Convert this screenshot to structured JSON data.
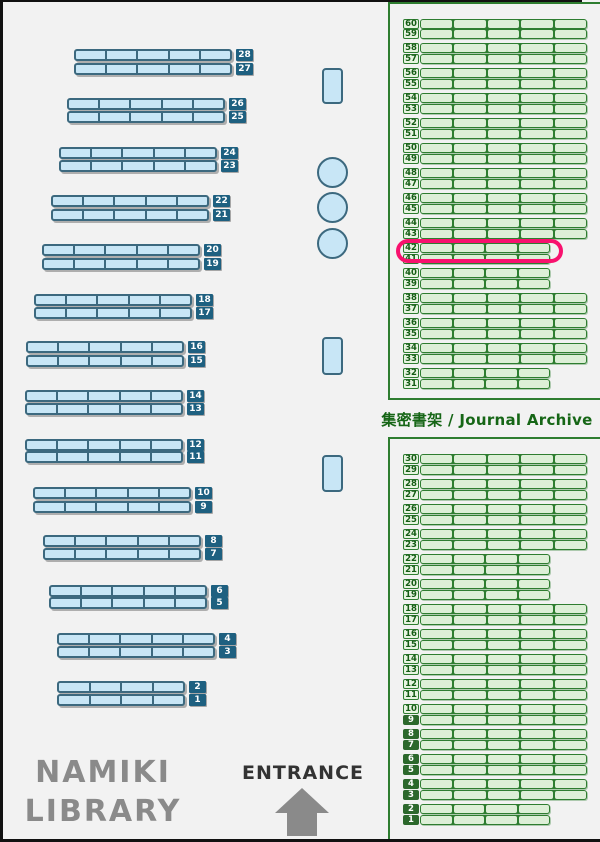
{
  "library": {
    "name_line1": "NAMIKI",
    "name_line2": "LIBRARY"
  },
  "entrance": {
    "label": "ENTRANCE"
  },
  "archive": {
    "label": "集密書架 / Journal Archive"
  },
  "highlight": {
    "target_shelf": 42,
    "color": "#f8116e",
    "x": 396,
    "y": 239,
    "w": 167,
    "h": 24
  },
  "colors": {
    "background": "#f2f2f2",
    "frame": "#111111",
    "blue_shelf_fill": "#c8e6f6",
    "blue_shelf_border": "#3c697f",
    "blue_label_bg": "#1e6080",
    "blue_label_text": "#ffffff",
    "green_shelf_fill": "#ddefd7",
    "green_shelf_border": "#2e7d30",
    "green_label_bg": "#e7f4e1",
    "green_label_text": "#155c15",
    "green_label_dark_bg": "#2c682c",
    "green_label_dark_text": "#ffffff",
    "archive_text": "#166616",
    "library_name_text": "#8a8a8a",
    "entrance_text": "#333333",
    "arrow": "#8a8a8a"
  },
  "left_shelves": {
    "default_width": 158,
    "default_segments": 5,
    "rows": [
      {
        "num": 28,
        "x": 74,
        "y": 49,
        "w": 158,
        "segments": 5
      },
      {
        "num": 27,
        "x": 74,
        "y": 63,
        "w": 158,
        "segments": 5
      },
      {
        "num": 26,
        "x": 67,
        "y": 98,
        "w": 158,
        "segments": 5
      },
      {
        "num": 25,
        "x": 67,
        "y": 111,
        "w": 158,
        "segments": 5
      },
      {
        "num": 24,
        "x": 59,
        "y": 147,
        "w": 158,
        "segments": 5
      },
      {
        "num": 23,
        "x": 59,
        "y": 160,
        "w": 158,
        "segments": 5
      },
      {
        "num": 22,
        "x": 51,
        "y": 195,
        "w": 158,
        "segments": 5
      },
      {
        "num": 21,
        "x": 51,
        "y": 209,
        "w": 158,
        "segments": 5
      },
      {
        "num": 20,
        "x": 42,
        "y": 244,
        "w": 158,
        "segments": 5
      },
      {
        "num": 19,
        "x": 42,
        "y": 258,
        "w": 158,
        "segments": 5
      },
      {
        "num": 18,
        "x": 34,
        "y": 294,
        "w": 158,
        "segments": 5
      },
      {
        "num": 17,
        "x": 34,
        "y": 307,
        "w": 158,
        "segments": 5
      },
      {
        "num": 16,
        "x": 26,
        "y": 341,
        "w": 158,
        "segments": 5
      },
      {
        "num": 15,
        "x": 26,
        "y": 355,
        "w": 158,
        "segments": 5
      },
      {
        "num": 14,
        "x": 25,
        "y": 390,
        "w": 158,
        "segments": 5
      },
      {
        "num": 13,
        "x": 25,
        "y": 403,
        "w": 158,
        "segments": 5
      },
      {
        "num": 12,
        "x": 25,
        "y": 439,
        "w": 158,
        "segments": 5
      },
      {
        "num": 11,
        "x": 25,
        "y": 451,
        "w": 158,
        "segments": 5
      },
      {
        "num": 10,
        "x": 33,
        "y": 487,
        "w": 158,
        "segments": 5
      },
      {
        "num": 9,
        "x": 33,
        "y": 501,
        "w": 158,
        "segments": 5
      },
      {
        "num": 8,
        "x": 43,
        "y": 535,
        "w": 158,
        "segments": 5
      },
      {
        "num": 7,
        "x": 43,
        "y": 548,
        "w": 158,
        "segments": 5
      },
      {
        "num": 6,
        "x": 49,
        "y": 585,
        "w": 158,
        "segments": 5
      },
      {
        "num": 5,
        "x": 49,
        "y": 597,
        "w": 158,
        "segments": 5
      },
      {
        "num": 4,
        "x": 57,
        "y": 633,
        "w": 158,
        "segments": 5
      },
      {
        "num": 3,
        "x": 57,
        "y": 646,
        "w": 158,
        "segments": 5
      },
      {
        "num": 2,
        "x": 57,
        "y": 681,
        "w": 128,
        "segments": 4
      },
      {
        "num": 1,
        "x": 57,
        "y": 694,
        "w": 128,
        "segments": 4
      }
    ]
  },
  "right_archive": {
    "label_x": 403,
    "shelf_x": 420,
    "full_w": 167,
    "short_w": 130,
    "full_segments": 5,
    "short_segments": 4,
    "top_rows": [
      {
        "num": 60,
        "y": 19,
        "short": false
      },
      {
        "num": 59,
        "y": 29,
        "short": false
      },
      {
        "num": 58,
        "y": 43,
        "short": false
      },
      {
        "num": 57,
        "y": 54,
        "short": false
      },
      {
        "num": 56,
        "y": 68,
        "short": false
      },
      {
        "num": 55,
        "y": 79,
        "short": false
      },
      {
        "num": 54,
        "y": 93,
        "short": false
      },
      {
        "num": 53,
        "y": 104,
        "short": false
      },
      {
        "num": 52,
        "y": 118,
        "short": false
      },
      {
        "num": 51,
        "y": 129,
        "short": false
      },
      {
        "num": 50,
        "y": 143,
        "short": false
      },
      {
        "num": 49,
        "y": 154,
        "short": false
      },
      {
        "num": 48,
        "y": 168,
        "short": false
      },
      {
        "num": 47,
        "y": 179,
        "short": false
      },
      {
        "num": 46,
        "y": 193,
        "short": false
      },
      {
        "num": 45,
        "y": 204,
        "short": false
      },
      {
        "num": 44,
        "y": 218,
        "short": false
      },
      {
        "num": 43,
        "y": 229,
        "short": false
      },
      {
        "num": 42,
        "y": 243,
        "short": true
      },
      {
        "num": 41,
        "y": 254,
        "short": true
      },
      {
        "num": 40,
        "y": 268,
        "short": true
      },
      {
        "num": 39,
        "y": 279,
        "short": true
      },
      {
        "num": 38,
        "y": 293,
        "short": false
      },
      {
        "num": 37,
        "y": 304,
        "short": false
      },
      {
        "num": 36,
        "y": 318,
        "short": false
      },
      {
        "num": 35,
        "y": 329,
        "short": false
      },
      {
        "num": 34,
        "y": 343,
        "short": false
      },
      {
        "num": 33,
        "y": 354,
        "short": false
      },
      {
        "num": 32,
        "y": 368,
        "short": true
      },
      {
        "num": 31,
        "y": 379,
        "short": true
      }
    ],
    "bottom_rows": [
      {
        "num": 30,
        "y": 454,
        "short": false
      },
      {
        "num": 29,
        "y": 465,
        "short": false
      },
      {
        "num": 28,
        "y": 479,
        "short": false
      },
      {
        "num": 27,
        "y": 490,
        "short": false
      },
      {
        "num": 26,
        "y": 504,
        "short": false
      },
      {
        "num": 25,
        "y": 515,
        "short": false
      },
      {
        "num": 24,
        "y": 529,
        "short": false
      },
      {
        "num": 23,
        "y": 540,
        "short": false
      },
      {
        "num": 22,
        "y": 554,
        "short": true
      },
      {
        "num": 21,
        "y": 565,
        "short": true
      },
      {
        "num": 20,
        "y": 579,
        "short": true
      },
      {
        "num": 19,
        "y": 590,
        "short": true
      },
      {
        "num": 18,
        "y": 604,
        "short": false
      },
      {
        "num": 17,
        "y": 615,
        "short": false
      },
      {
        "num": 16,
        "y": 629,
        "short": false
      },
      {
        "num": 15,
        "y": 640,
        "short": false
      },
      {
        "num": 14,
        "y": 654,
        "short": false
      },
      {
        "num": 13,
        "y": 665,
        "short": false
      },
      {
        "num": 12,
        "y": 679,
        "short": false
      },
      {
        "num": 11,
        "y": 690,
        "short": false
      },
      {
        "num": 10,
        "y": 704,
        "short": false
      },
      {
        "num": 9,
        "y": 715,
        "short": false
      },
      {
        "num": 8,
        "y": 729,
        "short": false
      },
      {
        "num": 7,
        "y": 740,
        "short": false
      },
      {
        "num": 6,
        "y": 754,
        "short": false
      },
      {
        "num": 5,
        "y": 765,
        "short": false
      },
      {
        "num": 4,
        "y": 779,
        "short": false
      },
      {
        "num": 3,
        "y": 790,
        "short": false
      },
      {
        "num": 2,
        "y": 804,
        "short": true
      },
      {
        "num": 1,
        "y": 815,
        "short": true
      }
    ]
  },
  "furniture": {
    "tables": [
      {
        "x": 322,
        "y": 68,
        "w": 21,
        "h": 36
      },
      {
        "x": 322,
        "y": 337,
        "w": 21,
        "h": 38
      },
      {
        "x": 322,
        "y": 455,
        "w": 21,
        "h": 37
      }
    ],
    "round_tables": [
      {
        "x": 317,
        "y": 157,
        "d": 31
      },
      {
        "x": 317,
        "y": 192,
        "d": 31
      },
      {
        "x": 317,
        "y": 228,
        "d": 31
      }
    ]
  }
}
